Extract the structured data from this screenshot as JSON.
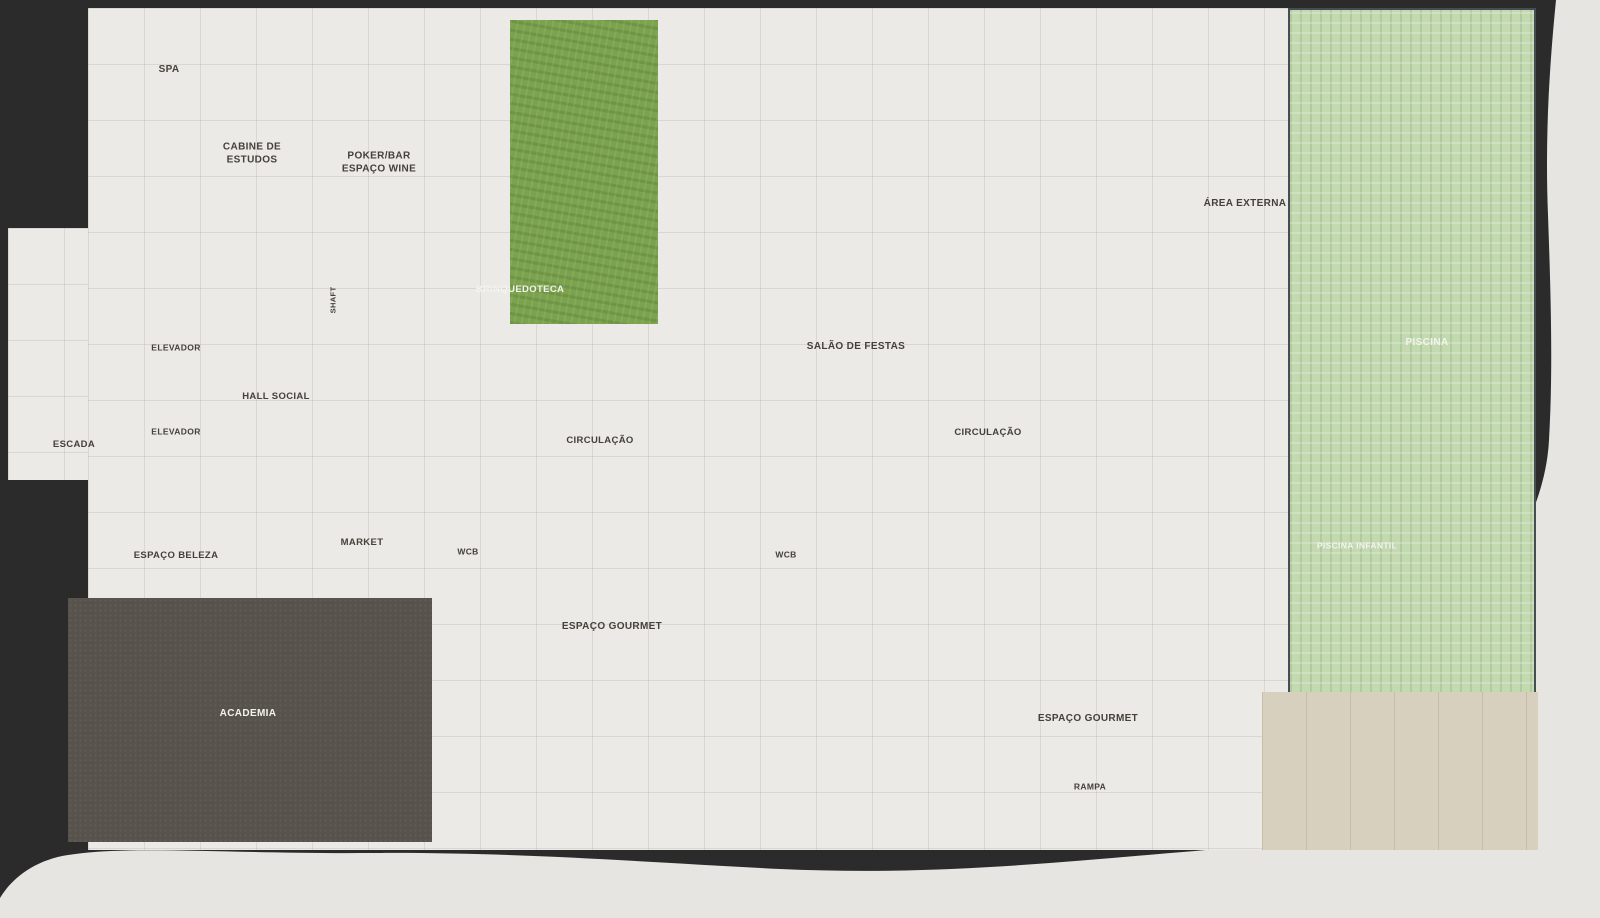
{
  "labels": {
    "spa": "SPA",
    "cabine": "CABINE DE ESTUDOS",
    "poker": "POKER/BAR ESPAÇO WINE",
    "brinquedoteca": "BRINQUEDOTECA",
    "salao": "SALÃO DE FESTAS",
    "area_externa": "ÁREA EXTERNA",
    "piscina": "PISCINA",
    "piscina_infantil": "PISCINA INFANTIL",
    "escada": "ESCADA",
    "elevador": "ELEVADOR",
    "hall_social": "HALL SOCIAL",
    "shaft": "SHAFT",
    "circulacao": "CIRCULAÇÃO",
    "espaco_beleza": "ESPAÇO BELEZA",
    "market": "MARKET",
    "wcb": "WCB",
    "academia": "ACADEMIA",
    "espaco_gourmet": "ESPAÇO GOURMET",
    "rampa": "RAMPA"
  },
  "colors": {
    "background": "#2b2b2b",
    "paper": "#e7e5e2",
    "marble": "#eceae6",
    "wall": "#171717",
    "grass": "#7ba24d",
    "pool_water": "#7e9b72",
    "pool_deck": "#c3d9b0",
    "sun_deck": "#d8d0bf",
    "gym_floor": "#57524b",
    "wood": "#c28a50",
    "chair_brown": "#ad6336",
    "chair_taupe": "#8c8376",
    "plant_dark": "#3c5529",
    "plant_light": "#5d7c3e",
    "accent_red": "#d96a5e",
    "accent_blue": "#b4d4e0",
    "banquette": "#d6cdb8"
  }
}
